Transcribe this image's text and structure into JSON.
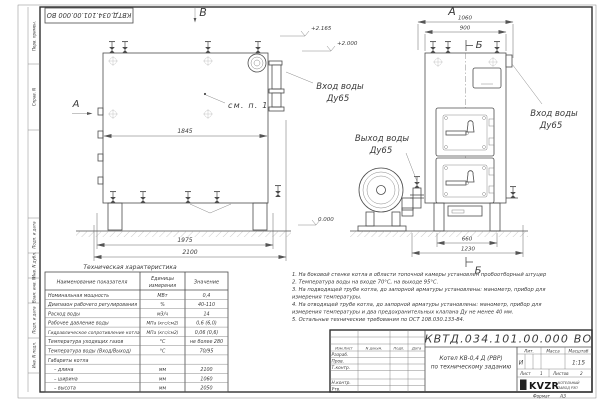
{
  "sheet": {
    "stamp_code": "КВТД.034.101.00.000 ВО",
    "format_label": "Формат",
    "format_value": "А3",
    "margin_labels": {
      "m0": "Перв. примен.",
      "m1": "Справ. N",
      "m2": "Подп. и дата",
      "m3": "Инв. N дубл.",
      "m4": "Взам. инв. N",
      "m5": "Подп. и дата",
      "m6": "Инв. N подл."
    }
  },
  "drawing": {
    "view_labels": {
      "v": "В",
      "a_top": "А",
      "a_side": "А",
      "b_top": "Б",
      "b_bottom": "Б"
    },
    "callouts": {
      "see_item": "см. п. 1",
      "inlet_left_1": "Вход воды",
      "inlet_left_2": "Ду65",
      "inlet_right_1": "Вход воды",
      "inlet_right_2": "Ду65",
      "outlet_1": "Выход воды",
      "outlet_2": "Ду65"
    },
    "elevations": {
      "top": "+2.165",
      "mid": "+2.000",
      "zero": "0.000"
    },
    "dimensions": {
      "d1845": "1845",
      "d1975": "1975",
      "d2100": "2100",
      "d1060": "1060",
      "d900": "900",
      "d660": "660",
      "d1230": "1230"
    }
  },
  "table": {
    "title": "Техническая характеристика",
    "col_name": "Наименование показателя",
    "col_unit_1": "Единицы",
    "col_unit_2": "измерения",
    "col_value": "Значение",
    "rows": [
      {
        "name": "Номинальная мощность",
        "unit": "МВт",
        "value": "0,4"
      },
      {
        "name": "Диапазон рабочего регулирования",
        "unit": "%",
        "value": "40-110"
      },
      {
        "name": "Расход воды",
        "unit": "м3/ч",
        "value": "14"
      },
      {
        "name": "Рабочее давление воды",
        "unit": "МПа (кгс/см2)",
        "value": "0,6 (6,0)"
      },
      {
        "name": "Гидравлическое сопротивление котла",
        "unit": "МПа (кгс/см2)",
        "value": "0,06 (0,6)"
      },
      {
        "name": "Температура уходящих газов",
        "unit": "°С",
        "value": "не более 280"
      },
      {
        "name": "Температура воды (Вход/Выход)",
        "unit": "°С",
        "value": "70/95"
      },
      {
        "name": "Габариты котла",
        "unit": "",
        "value": ""
      },
      {
        "name": "– длина",
        "unit": "мм",
        "value": "2100"
      },
      {
        "name": "– ширина",
        "unit": "мм",
        "value": "1060"
      },
      {
        "name": "– высота",
        "unit": "мм",
        "value": "2050"
      }
    ]
  },
  "notes": {
    "lines": [
      "1.  На боковой стенке котла в области топочной камеры установлен пробоотборный штуцер",
      "2.  Температура воды на входе 70°С, на выходе 95°С.",
      "3.  На подводящей трубе котла, до запорной арматуры установлены: манометр, прибор для",
      "измерения температуры.",
      "4.  На отводящей трубе котла, до запорной арматуры установлены: манометр, прибор для",
      "измерения температуры и два предохранительных клапана Ду не менее 40 мм.",
      "5.  Остальные технические требования по ОСТ 108.030.133-84."
    ]
  },
  "titleblock": {
    "code": "КВТД.034.101.00.000 ВО",
    "name_line1": "Котел КВ-0,4 Д (РВР)",
    "name_line2": "по техническому заданию",
    "hdr_izm": "Изм.Лист",
    "hdr_doc": "N докум.",
    "hdr_sign": "Подп.",
    "hdr_date": "Дата",
    "row_dev": "Разраб.",
    "row_check": "Пров.",
    "row_tcontr": "Т.контр.",
    "row_ncontr": "Н.контр.",
    "row_approve": "Утв.",
    "lit_label": "Лит.",
    "mass_label": "Масса",
    "scale_label": "Масштаб",
    "lit_value": "И",
    "scale_value": "1:15",
    "sheet_label": "Лист",
    "sheet_value": "1",
    "sheets_label": "Листов",
    "sheets_value": "2",
    "logo_text": "KVZR",
    "logo_sub1": "КОТЕЛЬНЫЙ",
    "logo_sub2": "ЗАВОД РЭП"
  }
}
